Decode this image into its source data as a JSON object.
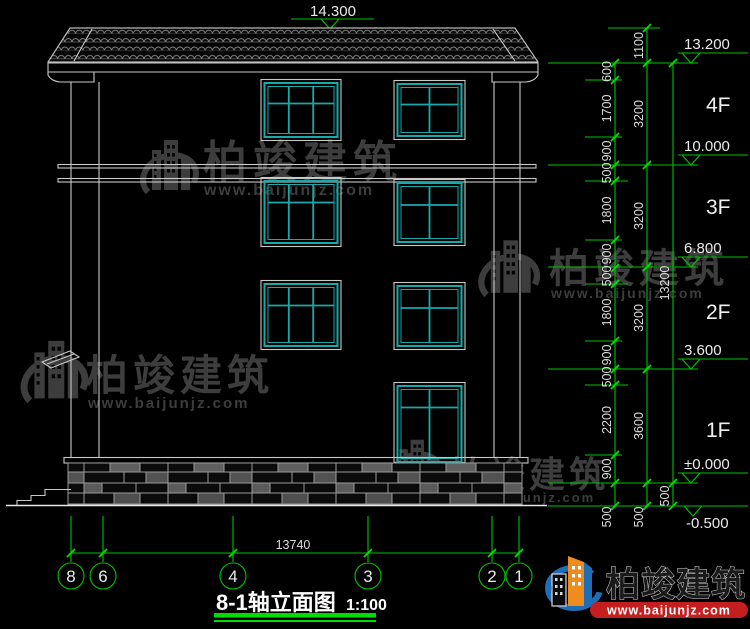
{
  "drawing": {
    "title": "8-1轴立面图",
    "scale": "1:100",
    "ridge_elevation": "14.300",
    "total_width_mm": "13740"
  },
  "levels": {
    "eave": "13.200",
    "f4": "10.000",
    "f3": "6.800",
    "f2": "3.600",
    "f1": "±0.000",
    "ground": "-0.500"
  },
  "floors": {
    "f4": "4F",
    "f3": "3F",
    "f2": "2F",
    "f1": "1F"
  },
  "dims": {
    "detail": [
      "600",
      "1700",
      "900",
      "500",
      "1800",
      "900",
      "500",
      "1800",
      "900",
      "500",
      "2200",
      "900",
      "500"
    ],
    "floor_heights": [
      "1100",
      "3200",
      "3200",
      "3200",
      "3600",
      "500"
    ],
    "totals": [
      "13200",
      "500"
    ]
  },
  "axes": [
    "8",
    "6",
    "4",
    "3",
    "2",
    "1"
  ],
  "watermark": {
    "brand": "柏竣建筑",
    "url": "www.baijunjz.com"
  },
  "logo": {
    "brand": "柏竣建筑",
    "url": "www.baijunjz.com"
  },
  "colors": {
    "background": "#000000",
    "drawing_lines": "#c8c8c8",
    "window_frame": "#17aaaa",
    "dimension_green": "#00c300",
    "accent_green": "#00dc00",
    "watermark_gray": "#3d3d3d",
    "logo_blue": "#1e6db6",
    "logo_orange": "#f08c1e",
    "banner_red": "#c41e1e"
  }
}
